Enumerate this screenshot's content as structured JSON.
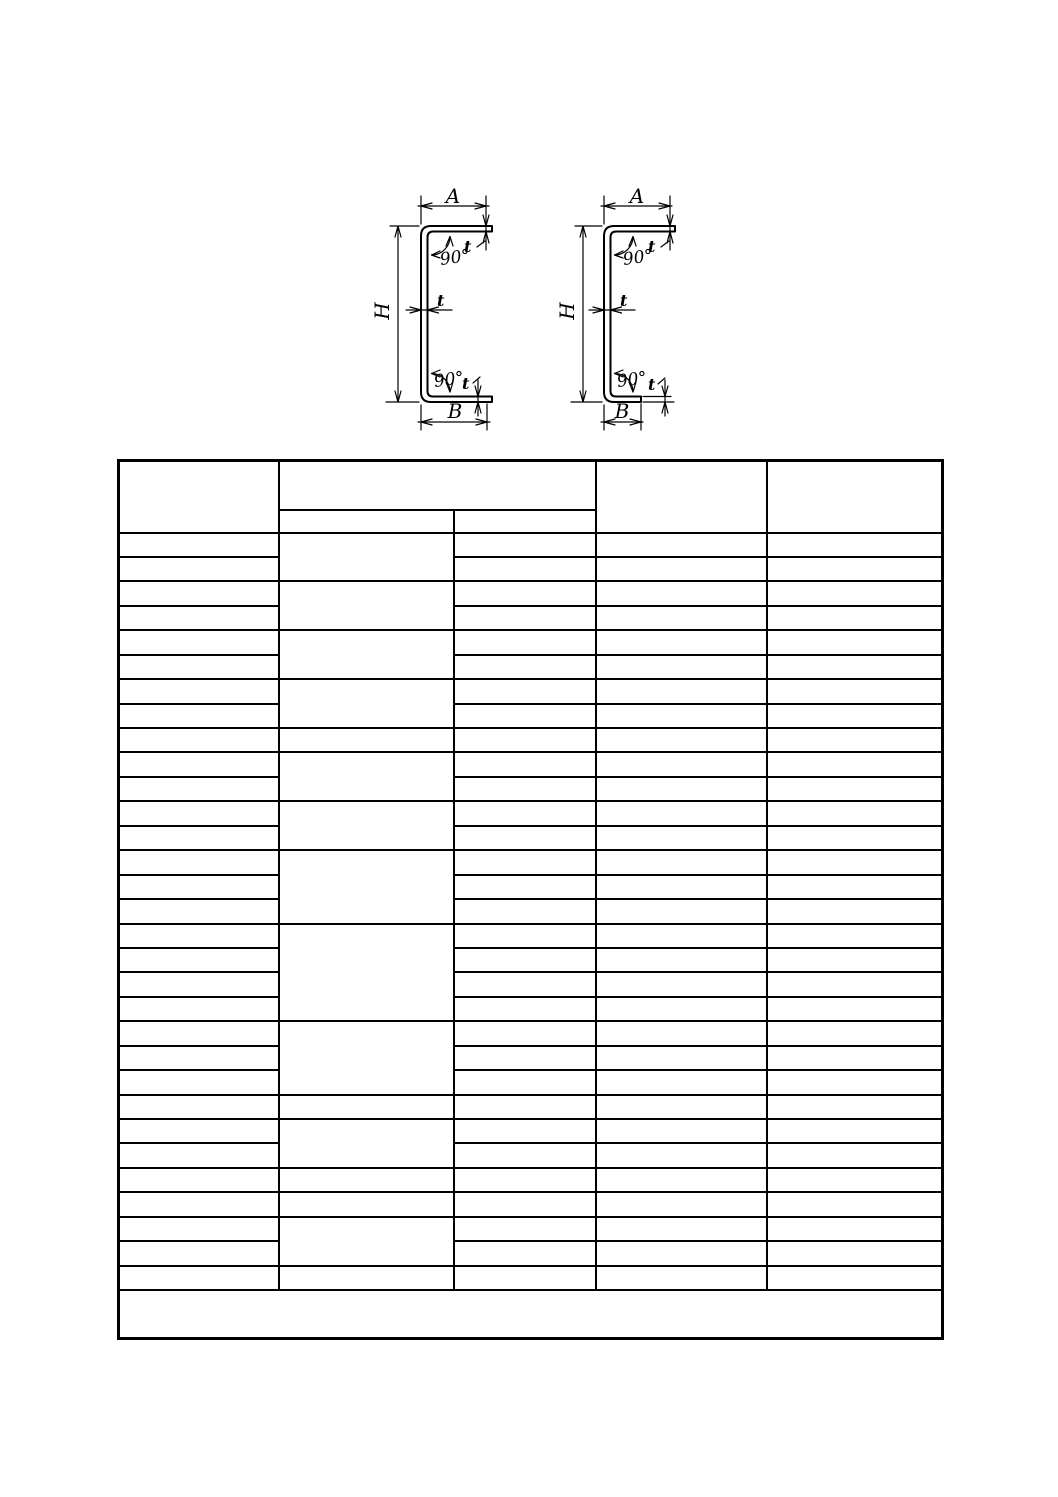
{
  "page": {
    "background": "#ffffff",
    "line_color": "#000000"
  },
  "diagrams": {
    "left_channel": {
      "description": "equal-flange cold-formed channel cross-section",
      "dim_a": "A",
      "dim_h": "H",
      "dim_b": "B",
      "thickness_top": "t",
      "thickness_web": "t",
      "thickness_bottom": "t",
      "angle_top": "90°",
      "angle_bottom": "90°"
    },
    "right_channel": {
      "description": "unequal-flange cold-formed channel cross-section",
      "dim_a": "A",
      "dim_h": "H",
      "dim_b": "B",
      "thickness_top": "t",
      "thickness_web": "t",
      "thickness_bottom": "t",
      "angle_top": "90°",
      "angle_bottom": "90°"
    }
  },
  "table": {
    "columns_count": 5,
    "rows_count": 31,
    "header": {
      "col1": "",
      "col2_group": "",
      "col2_sub": "",
      "col3_sub": "",
      "col4": "",
      "col5": ""
    },
    "body_groups": [
      2,
      2,
      2,
      2,
      1,
      2,
      2,
      3,
      4,
      3,
      1,
      2,
      1,
      1,
      2,
      1
    ],
    "footer_note": ""
  }
}
